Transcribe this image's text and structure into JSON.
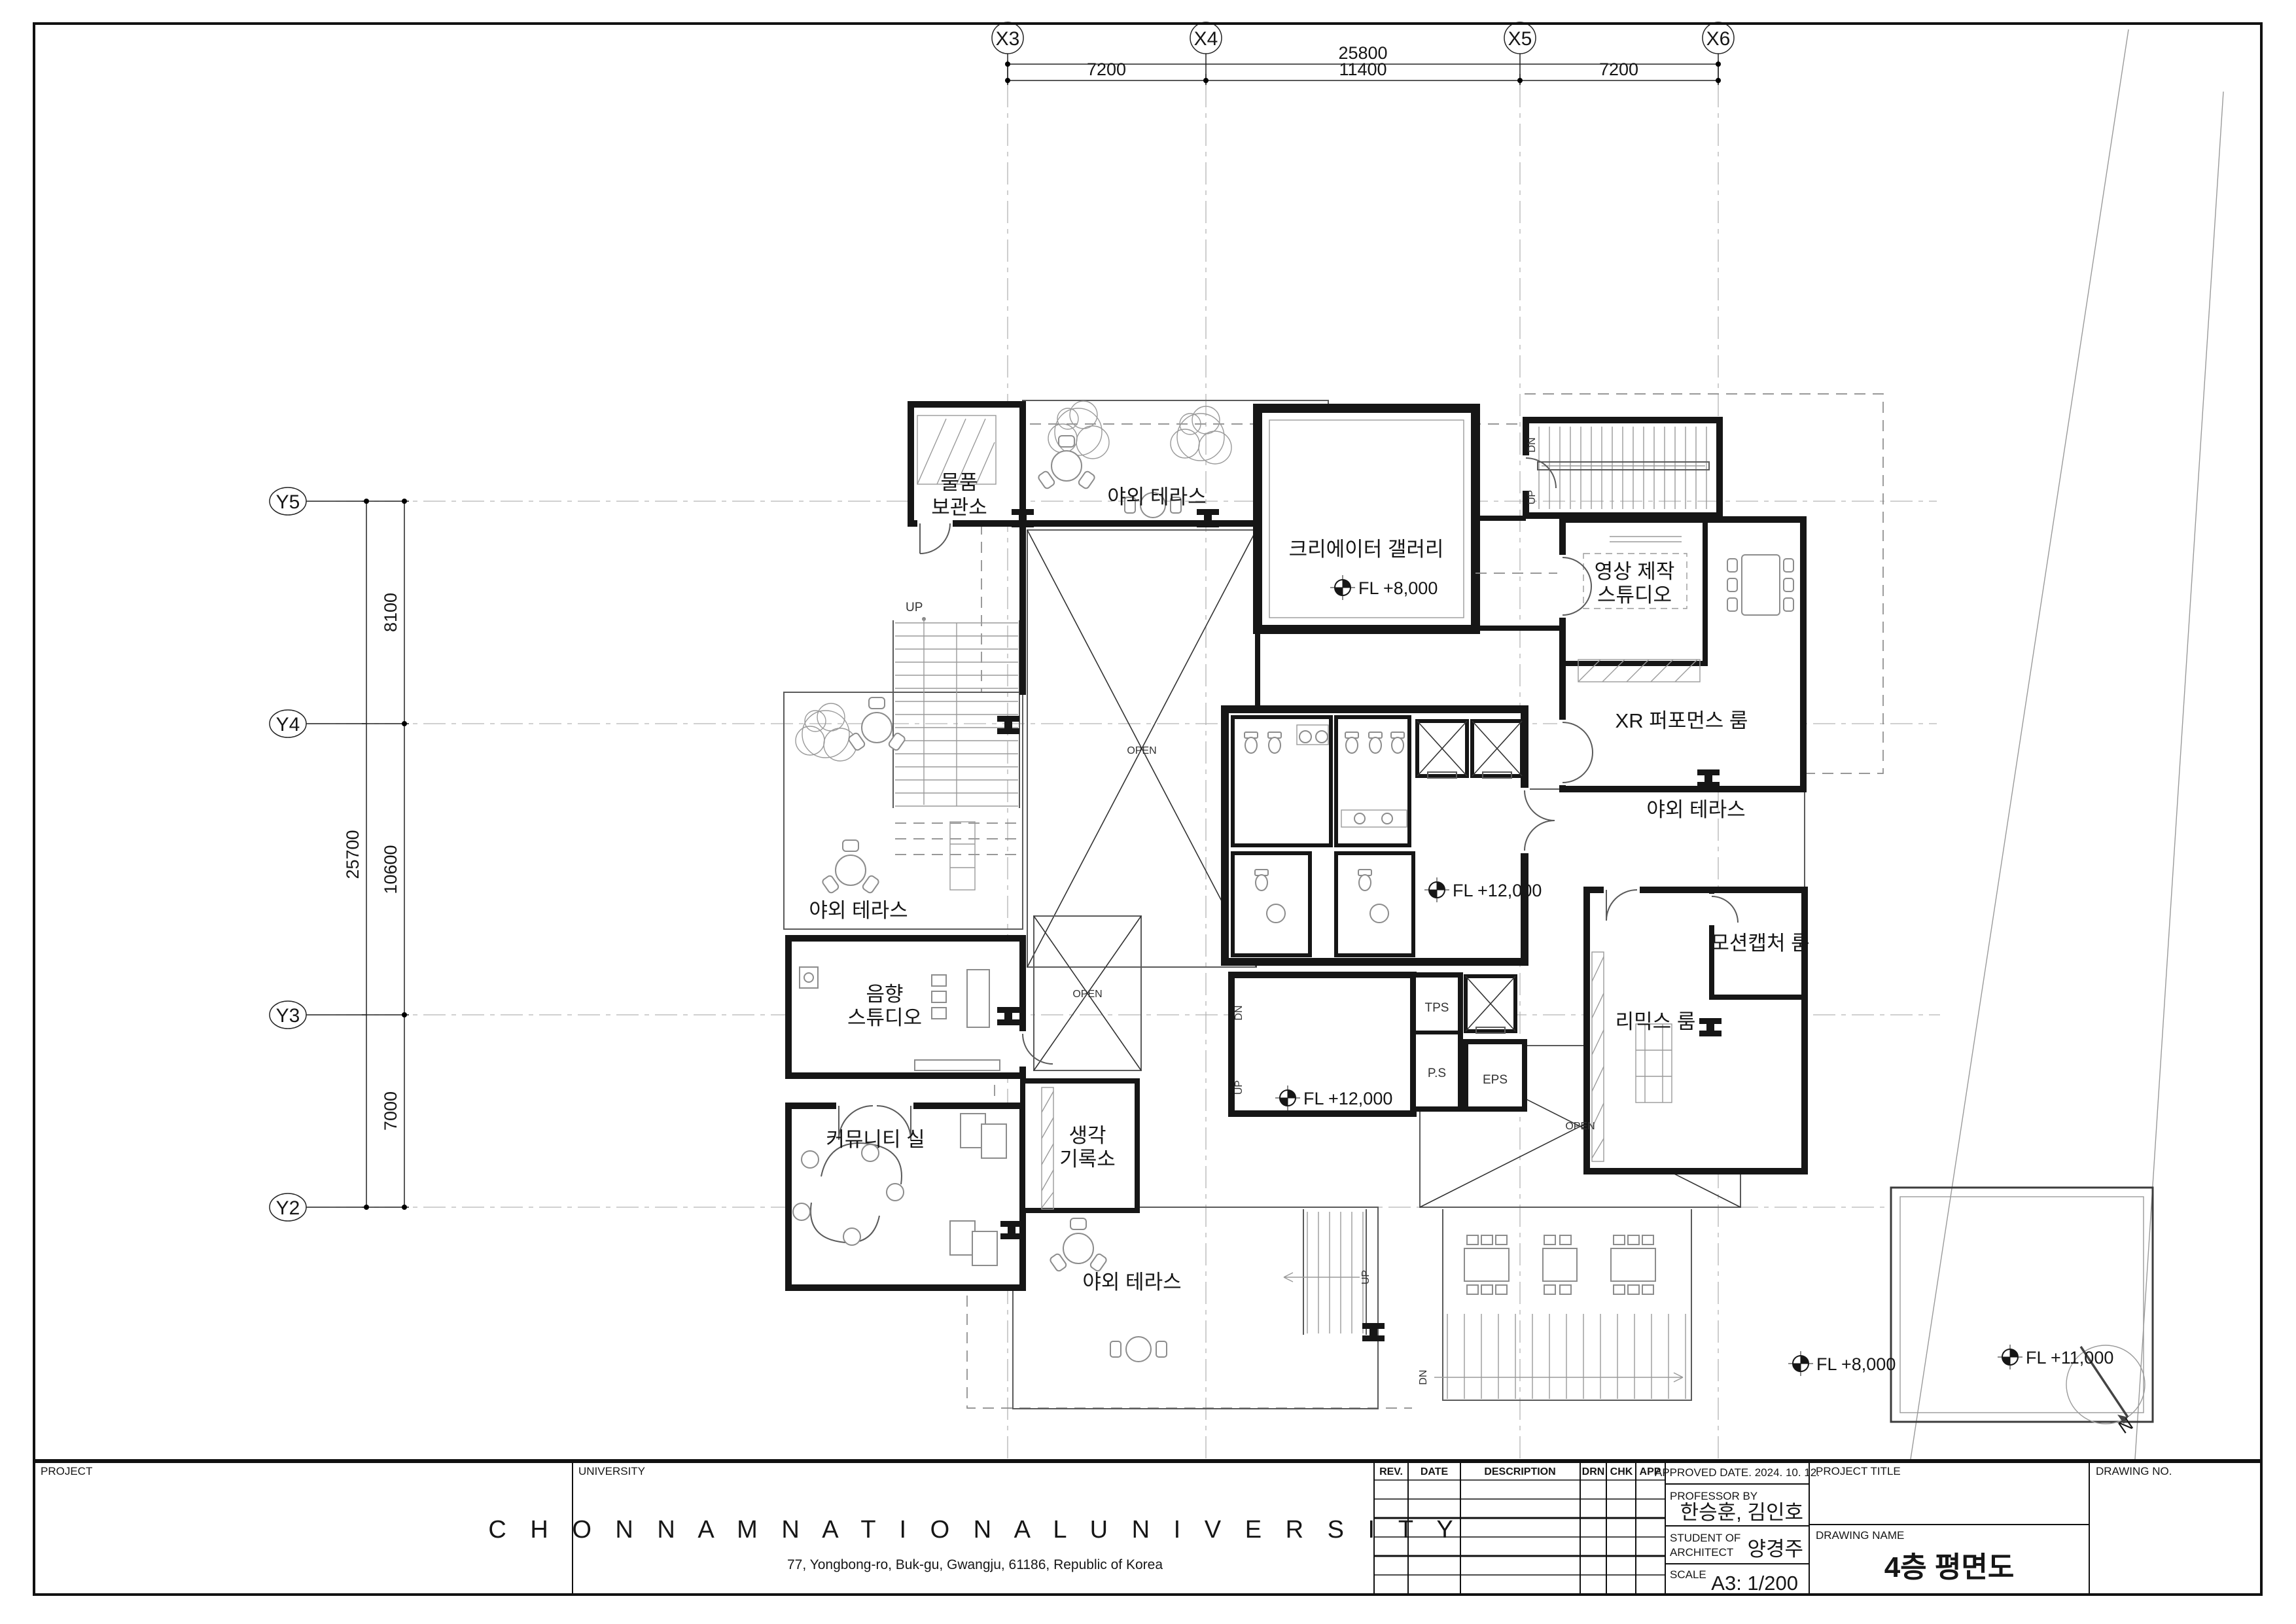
{
  "sheet": {
    "grid": {
      "x_labels": [
        "X3",
        "X4",
        "X5",
        "X6"
      ],
      "y_labels": [
        "Y5",
        "Y4",
        "Y3",
        "Y2"
      ],
      "x_total": "25800",
      "x_segments": [
        "7200",
        "11400",
        "7200"
      ],
      "y_total": "25700",
      "y_segments": [
        "8100",
        "10600",
        "7000"
      ]
    },
    "rooms": {
      "storage_line1": "물품",
      "storage_line2": "보관소",
      "terrace": "야외 테라스",
      "gallery": "크리에이터 갤러리",
      "video_line1": "영상 제작",
      "video_line2": "스튜디오",
      "xr": "XR 퍼포먼스 룸",
      "mocap": "모션캡처 룸",
      "remix": "리믹스 룸",
      "sound_line1": "음향",
      "sound_line2": "스튜디오",
      "community": "커뮤니티 실",
      "memo_line1": "생각",
      "memo_line2": "기록소"
    },
    "levels": {
      "fl8": "FL +8,000",
      "fl11": "FL +11,000",
      "fl12": "FL +12,000"
    },
    "marks": {
      "up": "UP",
      "dn": "DN",
      "open": "OPEN",
      "tps": "TPS",
      "ps": "P.S",
      "eps": "EPS",
      "north": "N"
    }
  },
  "titleblock": {
    "project_label": "PROJECT",
    "university_label": "UNIVERSITY",
    "university_name": "C H O N N A M   N A T I O N A L   U N I V E R S I T Y",
    "university_address": "77, Yongbong-ro, Buk-gu, Gwangju, 61186, Republic of Korea",
    "rev_headers": [
      "REV.",
      "DATE",
      "DESCRIPTION",
      "DRN",
      "CHK",
      "APP"
    ],
    "approved": "APPROVED DATE.  2024. 10. 12.",
    "professor_label": "PROFESSOR BY",
    "professor": "한승훈, 김인호",
    "student_label1": "STUDENT OF",
    "student_label2": "ARCHITECT",
    "student": "양경주",
    "scale_label": "SCALE",
    "scale": "A3: 1/200",
    "project_title_label": "PROJECT TITLE",
    "drawing_name_label": "DRAWING NAME",
    "drawing_name": "4층 평면도",
    "drawing_no_label": "DRAWING NO."
  }
}
